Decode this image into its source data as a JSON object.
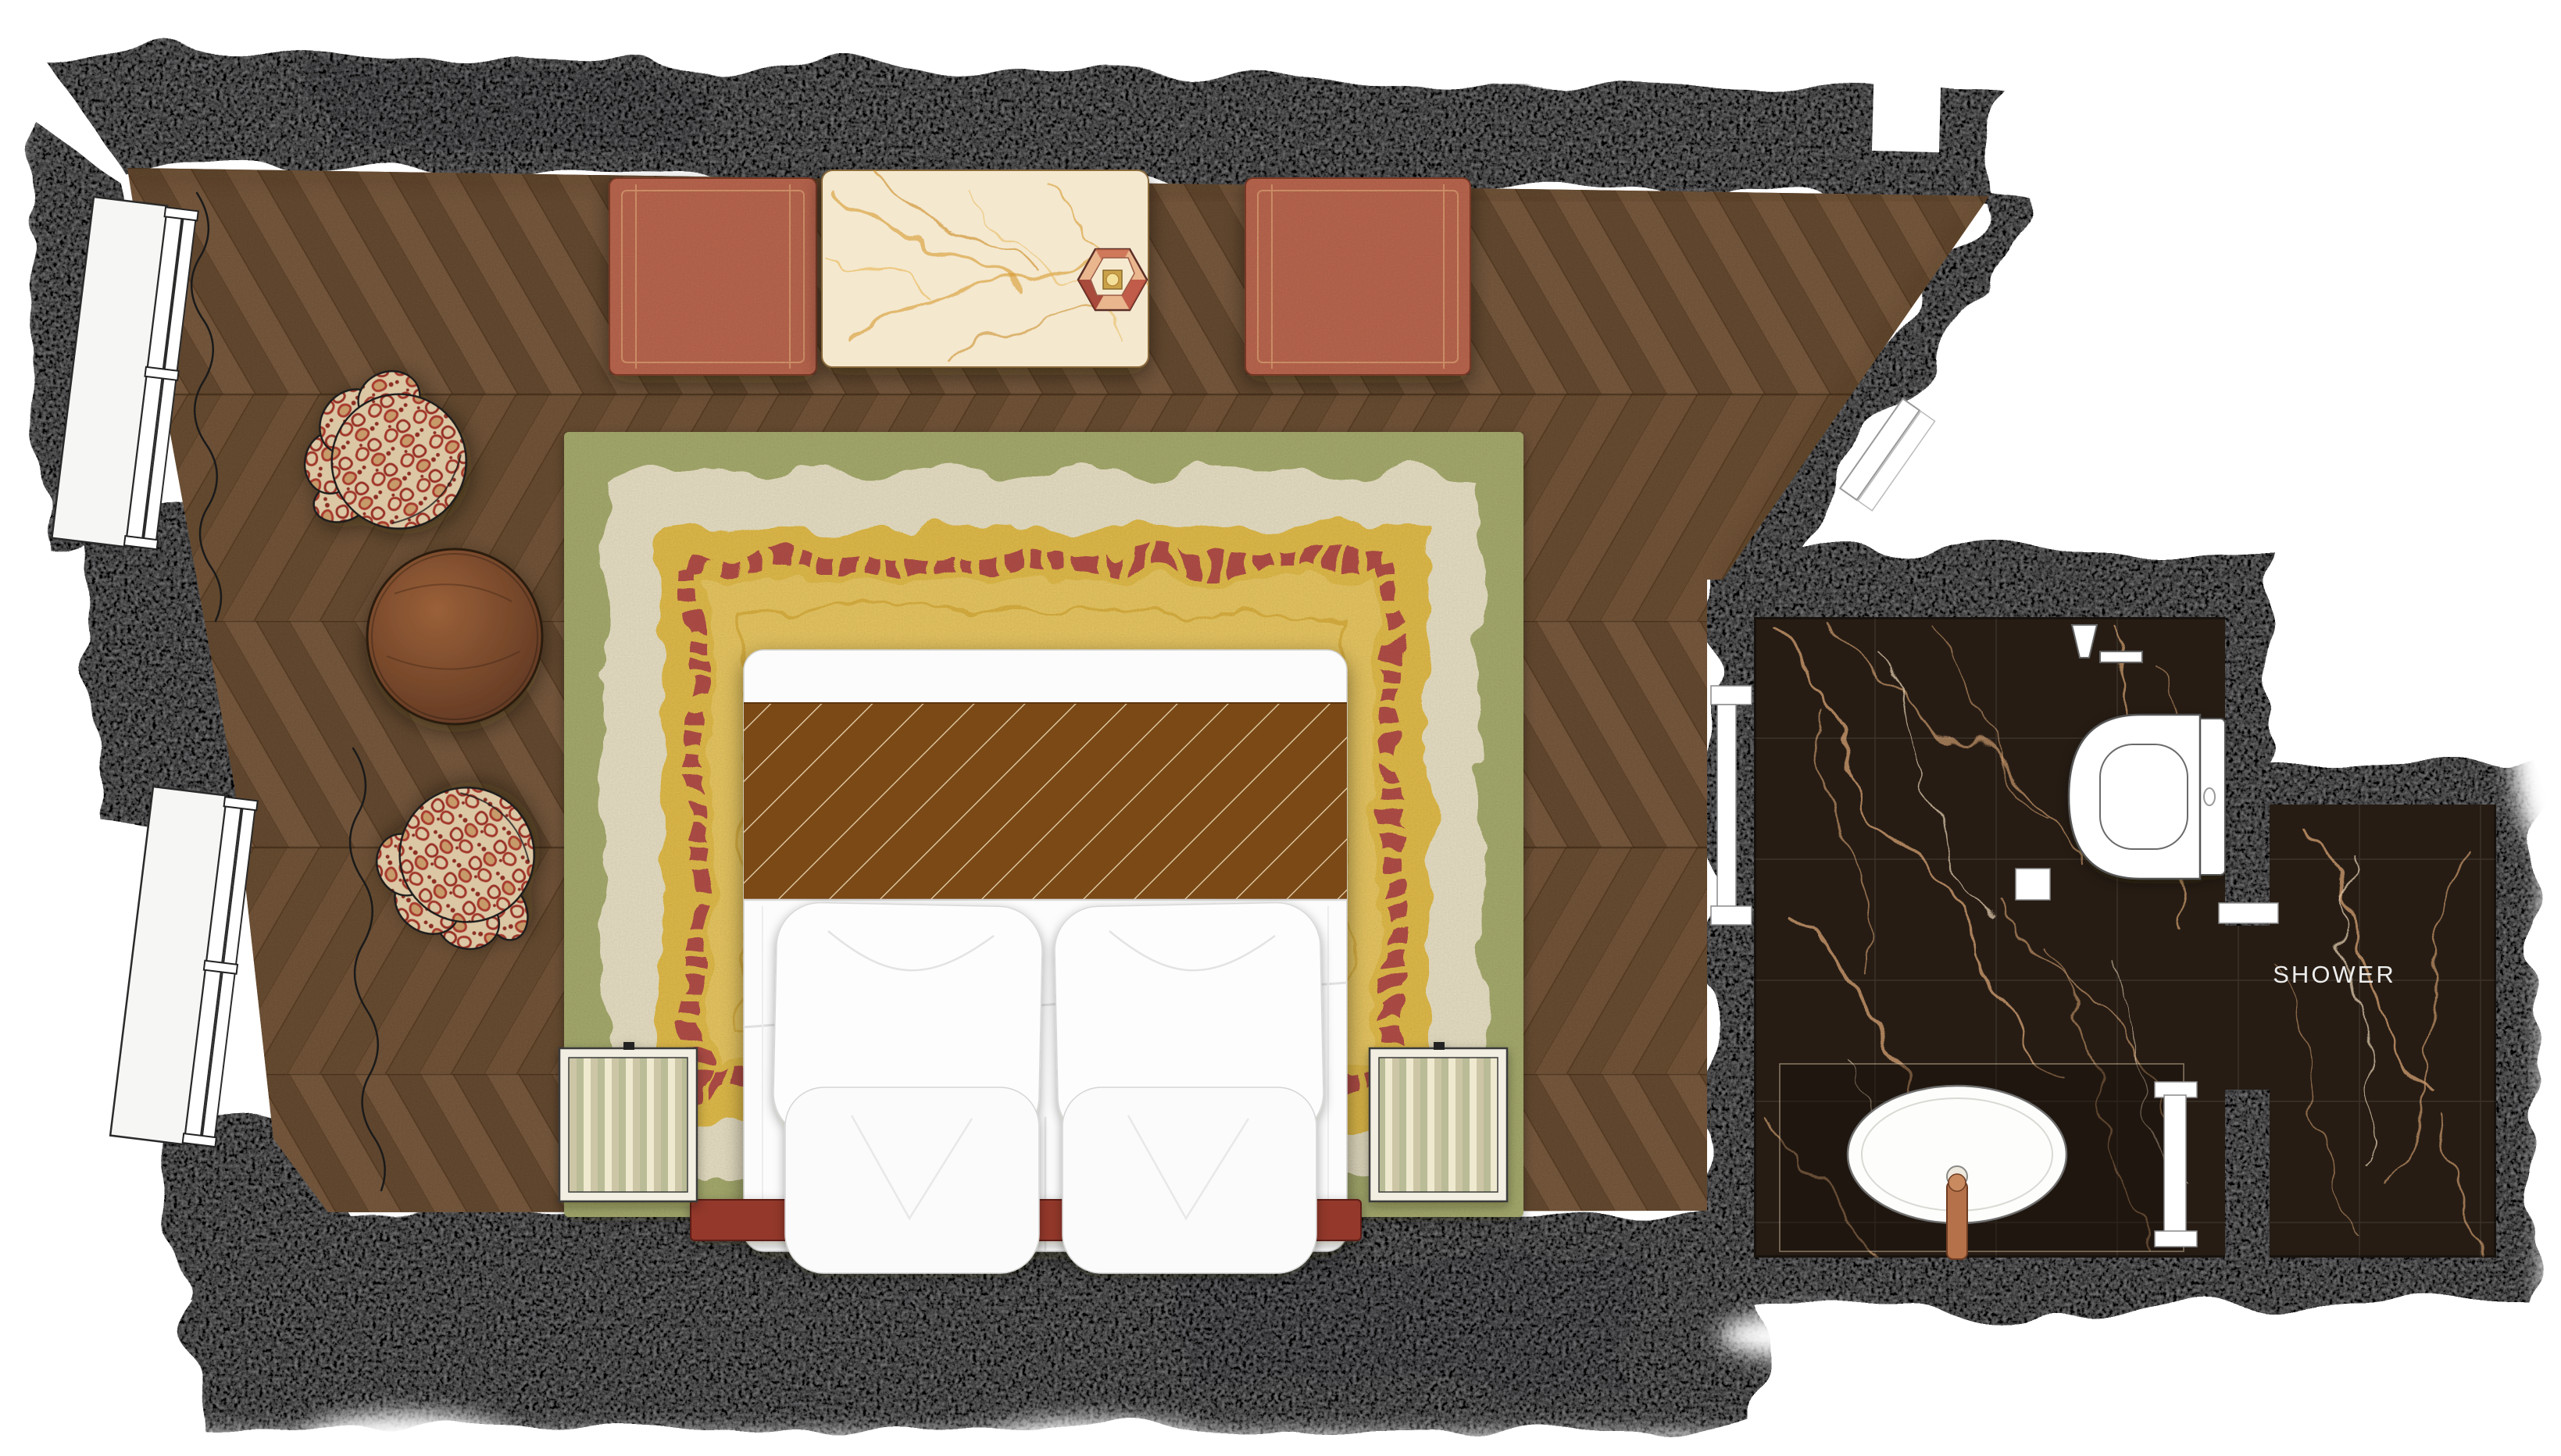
{
  "labels": {
    "shower": "SHOWER"
  },
  "colors": {
    "wall_gray": "#9b9b9e",
    "floor_wood": "#76573a",
    "wood_plank_light": "#7e5e41",
    "wood_plank_dark": "#6b4e33",
    "rug_green": "#a9ae6f",
    "rug_cream": "#ece4c8",
    "rug_yellow": "#e5bf4c",
    "rug_red_border": "#b5504a",
    "rug_field": "#ecca63",
    "bench_terracotta": "#c16a52",
    "console_marble": "#f4e8cf",
    "console_vein": "#d6992f",
    "bath_marble": "#261c14",
    "bath_vein": "#c9996b",
    "bed_white": "#fcfcfc",
    "bed_runner_brown": "#7a4916",
    "headboard_red": "#93392c",
    "leopard_base": "#dcc7a5",
    "leopard_spot": "#a2372b",
    "side_table_wood": "#7e4a2e",
    "nightstand_stripe": "#cdc6a6",
    "fixture_white": "#ffffff",
    "shower_label_color": "#ededed"
  },
  "furniture": [
    "window",
    "curtain-squiggle",
    "leopard-armchair",
    "round-side-table",
    "terracotta-bench",
    "marble-console-table",
    "hexagonal-table-lamp",
    "layered-area-rug",
    "double-bed",
    "pillow",
    "striped-nightstand",
    "headboard-bench",
    "toilet",
    "toilet-roll-holder",
    "vanity-counter",
    "oval-washbasin",
    "faucet",
    "shower-door",
    "bathroom-door",
    "entry-door"
  ]
}
